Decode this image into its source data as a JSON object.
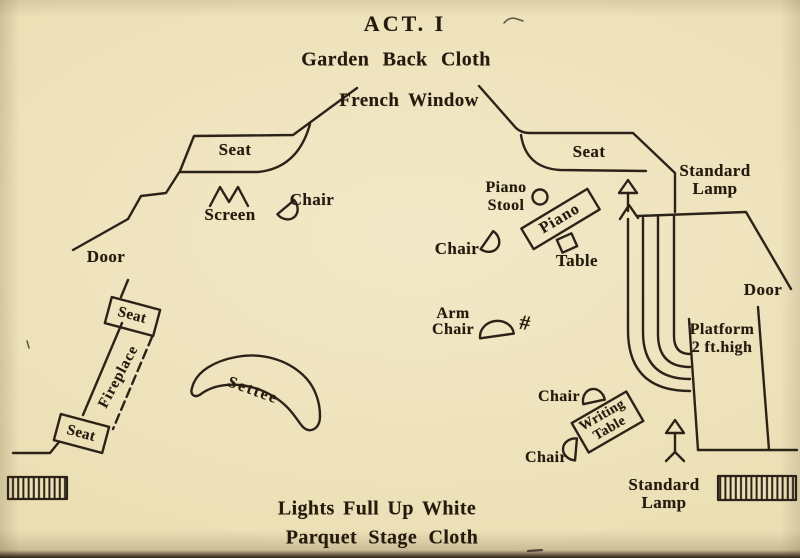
{
  "page": {
    "title": "ACT. I",
    "backdrop": "Garden Back Cloth",
    "window": "French Window",
    "footer_line1": "Lights Full Up White",
    "footer_line2": "Parquet Stage Cloth"
  },
  "labels": {
    "seat_left": "Seat",
    "seat_right": "Seat",
    "screen": "Screen",
    "chair_screen": "Chair",
    "door_left": "Door",
    "door_right": "Door",
    "standard_lamp_top": {
      "line1": "Standard",
      "line2": "Lamp"
    },
    "standard_lamp_bottom": {
      "line1": "Standard",
      "line2": "Lamp"
    },
    "piano_stool": {
      "line1": "Piano",
      "line2": "Stool"
    },
    "piano": "Piano",
    "chair_piano": "Chair",
    "table": "Table",
    "platform": {
      "line1": "Platform",
      "line2": "2 ft.high"
    },
    "arm_chair": {
      "line1": "Arm",
      "line2": "Chair"
    },
    "arm_chair_mark": "#",
    "seat_fireplace_top": "Seat",
    "fireplace": "Fireplace",
    "seat_fireplace_bottom": "Seat",
    "settee": "Settee",
    "chair_writing_top": "Chair",
    "writing_table": {
      "line1": "Writing",
      "line2": "Table"
    },
    "chair_writing_bottom": "Chair"
  },
  "colors": {
    "paper": "#ecdfb5",
    "ink": "#2c2318"
  }
}
